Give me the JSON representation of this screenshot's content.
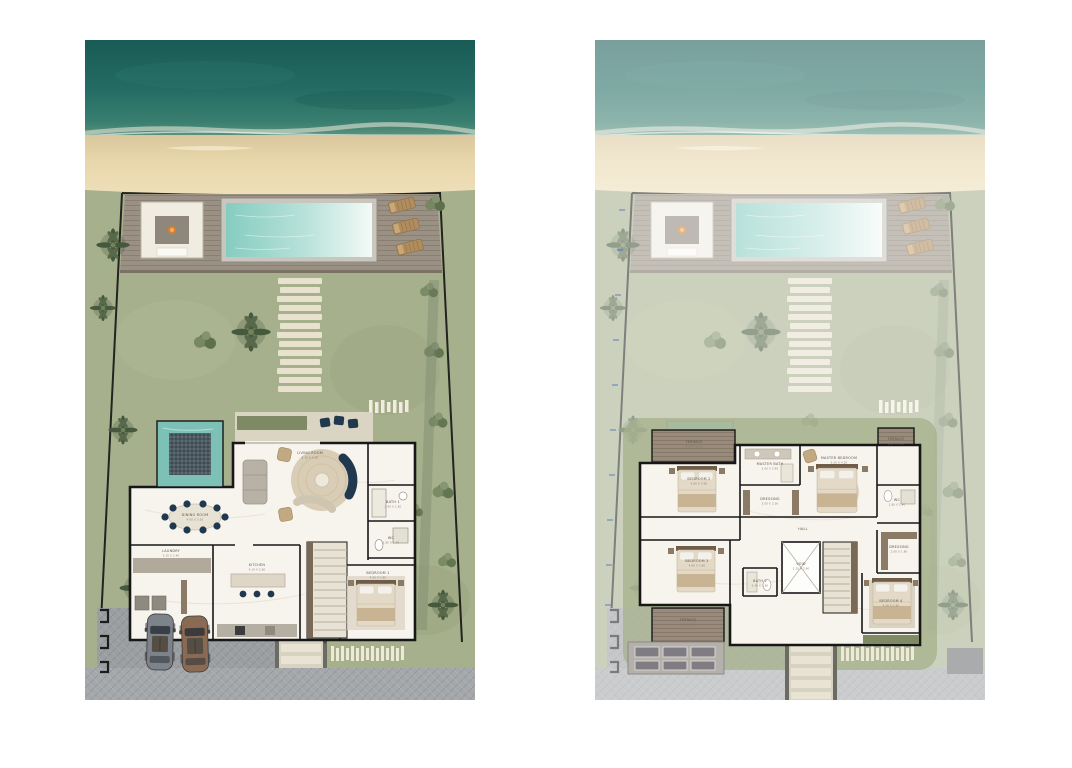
{
  "document": {
    "type": "villa-site-floor-plans",
    "background": "#ffffff",
    "panel_count": 2
  },
  "colors": {
    "ocean": "#1e665f",
    "surf_foam": "#f0ecdf",
    "sand": "#e8d6ab",
    "lawn": "#a6b08c",
    "deck_wood": "#9a9184",
    "terrace_wood": "#968779",
    "pool_water_left": "#86ccc0",
    "pool_water_right": "#f3faf7",
    "plunge_pool": "#7cc0b6",
    "mosaic": "#4e5a61",
    "wall": "#171717",
    "marble_floor": "#f7f4ee",
    "navy_furniture": "#20394f",
    "tan_furniture": "#b08d5f",
    "road": "#a4a8ab",
    "stone_path": "#ece4d2",
    "fire": "#d97f2e",
    "fade_overlay": "rgba(255,255,255,0.42)",
    "dimension_blue": "#3a62c4"
  },
  "plans": [
    {
      "id": "ground-floor",
      "rooms": {
        "living": {
          "name": "LIVING ROOM",
          "dims": "6.10 X 5.00"
        },
        "dining": {
          "name": "DINING ROOM",
          "dims": "4.00 X 3.20"
        },
        "kitchen": {
          "name": "KITCHEN",
          "dims": "4.10 X 2.60"
        },
        "laundry": {
          "name": "LAUNDRY",
          "dims": "3.20 X 2.40"
        },
        "bedroom1": {
          "name": "BEDROOM 1",
          "dims": "4.00 X 3.60"
        },
        "bath1": {
          "name": "BATH 1",
          "dims": "2.40 X 1.60"
        },
        "wc": {
          "name": "WC",
          "dims": "1.80 X 1.20"
        }
      }
    },
    {
      "id": "first-floor",
      "rooms": {
        "terrace_nw": {
          "name": "TERRACE",
          "dims": "4.60 X 2.00"
        },
        "terrace_ne": {
          "name": "TERRACE",
          "dims": "3.00 X 2.40"
        },
        "terrace_sw": {
          "name": "TERRACE",
          "dims": "4.60 X 2.20"
        },
        "bedroom2": {
          "name": "BEDROOM 2",
          "dims": "4.60 X 4.00"
        },
        "bedroom3": {
          "name": "BEDROOM 3",
          "dims": "4.60 X 3.80"
        },
        "bedroom4": {
          "name": "BEDROOM 4",
          "dims": "4.20 X 3.60"
        },
        "master_bedroom": {
          "name": "MASTER BEDROOM",
          "dims": "5.00 X 4.20"
        },
        "master_bath": {
          "name": "MASTER BATH",
          "dims": "3.00 X 2.40"
        },
        "dressing": {
          "name": "DRESSING",
          "dims": "3.00 X 2.00"
        },
        "dressing2": {
          "name": "DRESSING",
          "dims": "2.60 X 1.80"
        },
        "bath2": {
          "name": "BATH 2",
          "dims": "2.40 X 1.80"
        },
        "wc": {
          "name": "WC",
          "dims": "1.80 X 1.40"
        },
        "void": {
          "name": "VOID",
          "dims": "3.20 X 2.60"
        },
        "hall": {
          "name": "HALL",
          "dims": ""
        }
      }
    }
  ]
}
